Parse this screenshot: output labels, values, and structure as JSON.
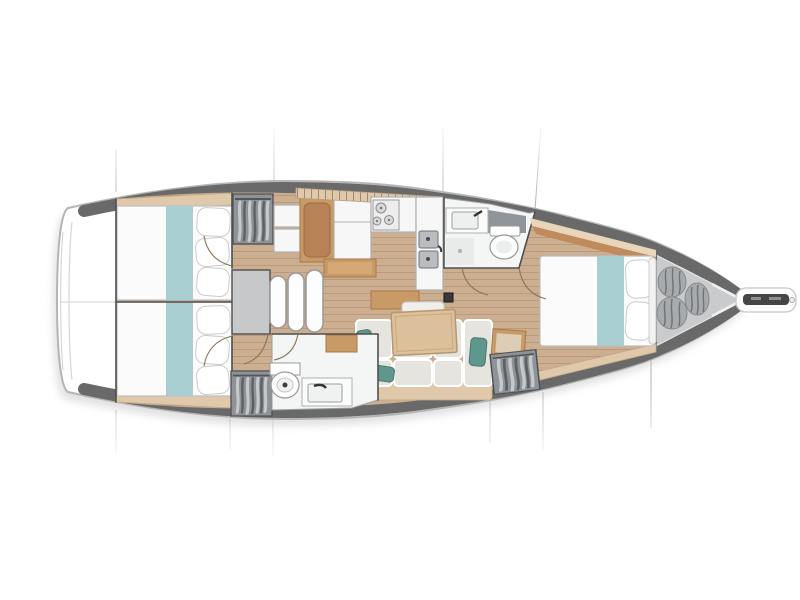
{
  "meta": {
    "title": "Sailing yacht interior layout plan, top-down view",
    "orientation": "bow pointing right, stern at left"
  },
  "colors": {
    "hull_outline": "#b5b5b5",
    "deck_band": "#696969",
    "wood_floor": "#ccae90",
    "plank_line": "#bb9a7c",
    "wood_trim": "#c89b66",
    "wood_trim_dark": "#a87848",
    "wood_light": "#dfc9aa",
    "band_brown": "#bf8a5c",
    "band_light": "#e8d5ba",
    "brown_cushion": "#b78257",
    "table_wood": "#dcc09c",
    "teal_runner": "#a9ced2",
    "teal_pillow": "#5f968d",
    "sofa_cushion": "#e6e4de",
    "locker_gray": "#8f9296",
    "clothes_light": "#c6c9cc",
    "clothes_dark": "#5d6064",
    "sail_floor": "#c9cbcd",
    "sail_bag": "#a8abae",
    "bag_crease": "#6f7377",
    "steel": "#b9bdbf",
    "fixture_dark": "#454545",
    "wall": "#4f4f4f",
    "section_line": "#a8a8a8",
    "room_white": "#f4f5f5",
    "furn_white": "#f7f7f7",
    "furn_stroke": "#b0b0b0",
    "arc": "#8b7355"
  },
  "diagram": {
    "type": "yacht deck floor plan",
    "compartments": [
      {
        "name": "aft-cabin-port",
        "features": [
          "double berth",
          "teal bed runner",
          "pillows",
          "hanging locker with clothes"
        ]
      },
      {
        "name": "aft-cabin-starboard",
        "features": [
          "double berth",
          "teal bed runner",
          "pillows",
          "hanging locker with clothes"
        ]
      },
      {
        "name": "companionway",
        "features": [
          "landing platform",
          "3 curved steps"
        ]
      },
      {
        "name": "nav-station",
        "features": [
          "bench seat",
          "white desk",
          "wood sideboard"
        ]
      },
      {
        "name": "galley",
        "features": [
          "3-burner stove",
          "double stainless sink",
          "white counters",
          "hatched locker row"
        ]
      },
      {
        "name": "forward-head",
        "features": [
          "vanity sink",
          "toilet",
          "shower floor",
          "angled bulkhead"
        ]
      },
      {
        "name": "aft-head",
        "features": [
          "toilet",
          "vanity sink",
          "wood locker"
        ]
      },
      {
        "name": "saloon",
        "features": [
          "sofa with cushions",
          "3 teal pillows",
          "wooden table",
          "side seat",
          "hanging locker",
          "mast foot"
        ]
      },
      {
        "name": "forward-cabin",
        "features": [
          "island double berth",
          "teal bed runner",
          "2 pillows",
          "hull-side shelves"
        ]
      },
      {
        "name": "sail-locker",
        "features": [
          "3 sail bags"
        ]
      },
      {
        "name": "bow",
        "features": [
          "anchor roller fitting"
        ]
      }
    ],
    "section_lines": {
      "top_x": [
        116,
        274,
        443,
        541
      ],
      "bottom_x": [
        116,
        230,
        273,
        490,
        543,
        651
      ]
    }
  }
}
